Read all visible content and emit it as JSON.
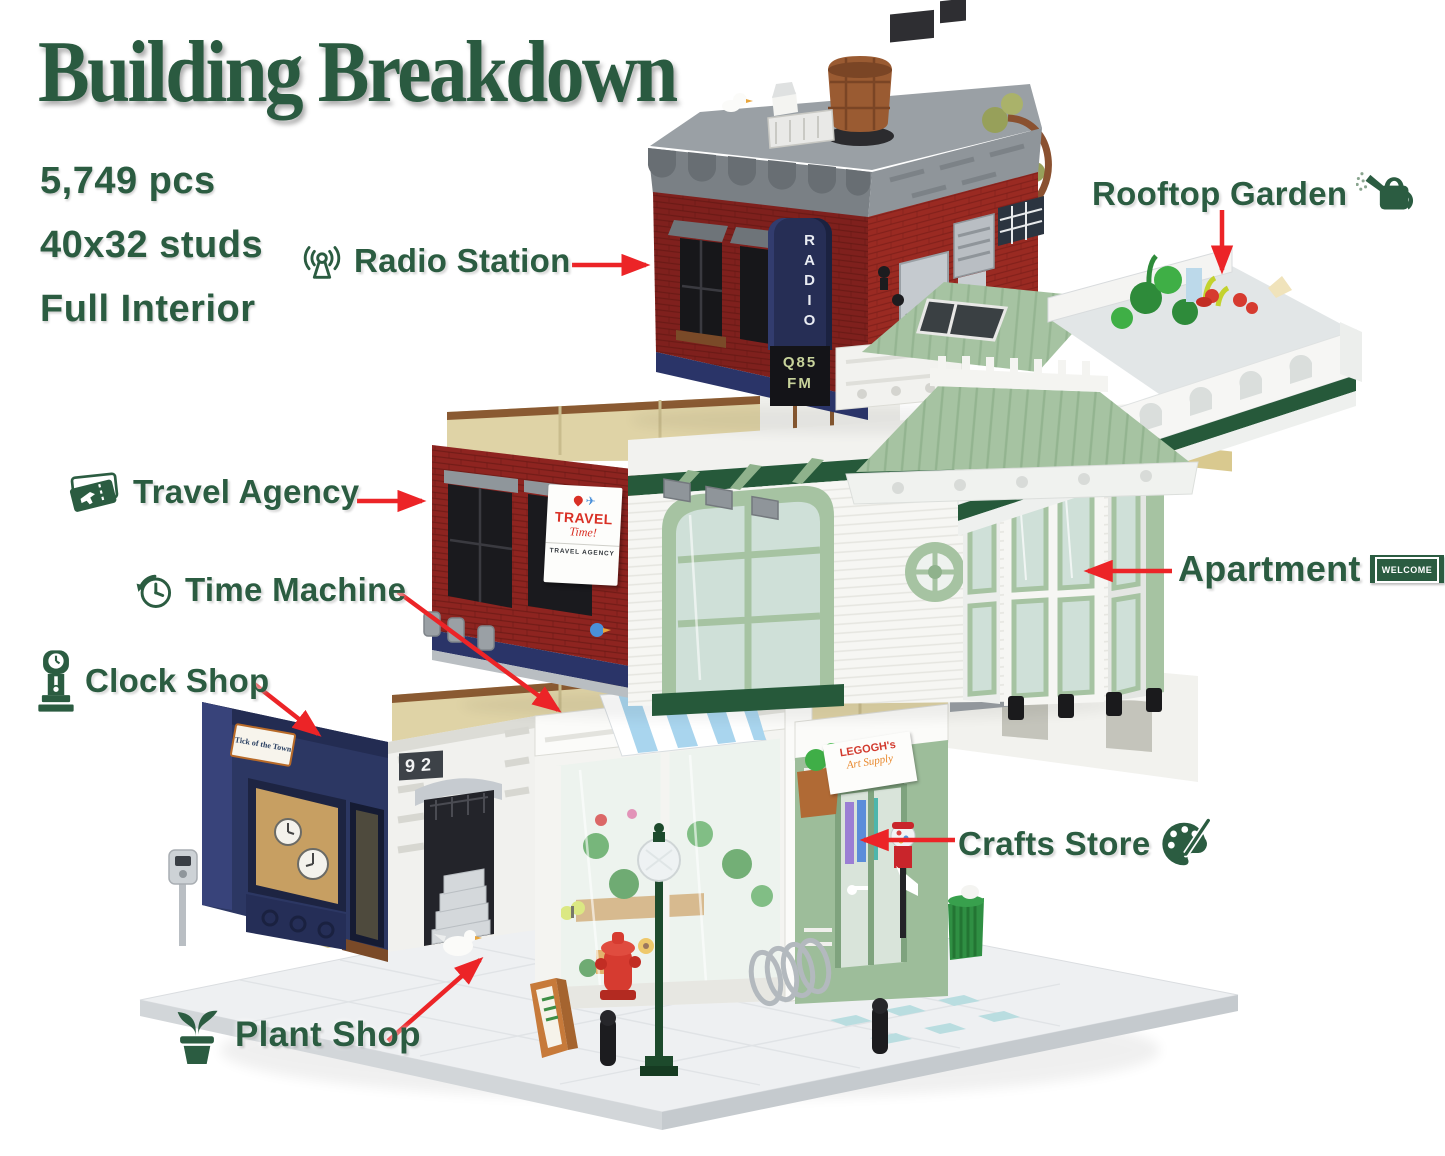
{
  "title": "Building Breakdown",
  "stats": {
    "pieces": "5,749 pcs",
    "dimensions": "40x32 studs",
    "interior": "Full Interior"
  },
  "labels": {
    "radio_station": "Radio Station",
    "rooftop_garden": "Rooftop Garden",
    "travel_agency": "Travel Agency",
    "time_machine": "Time Machine",
    "clock_shop": "Clock Shop",
    "apartment": "Apartment",
    "crafts_store": "Crafts Store",
    "plant_shop": "Plant Shop"
  },
  "signs": {
    "radio_board": "RADIO",
    "radio_freq": "Q85",
    "radio_band": "FM",
    "travel_title": "TRAVEL",
    "travel_script": "Time!",
    "travel_sub": "TRAVEL AGENCY",
    "door_number": "92",
    "clock_shop": "Tick of the Town",
    "welcome_mat": "WELCOME",
    "crafts_line1": "LEGOGH's",
    "crafts_line2": "Art Supply"
  },
  "colors": {
    "text_green": "#2b5c41",
    "arrow_red": "#ec2427",
    "brick_red": "#8e2420",
    "sand_green": "#a6c3a2",
    "dark_green": "#26593a",
    "navy_blue": "#2c3763",
    "tan_wall": "#dfd3a6",
    "roof_gray": "#8b9196"
  }
}
